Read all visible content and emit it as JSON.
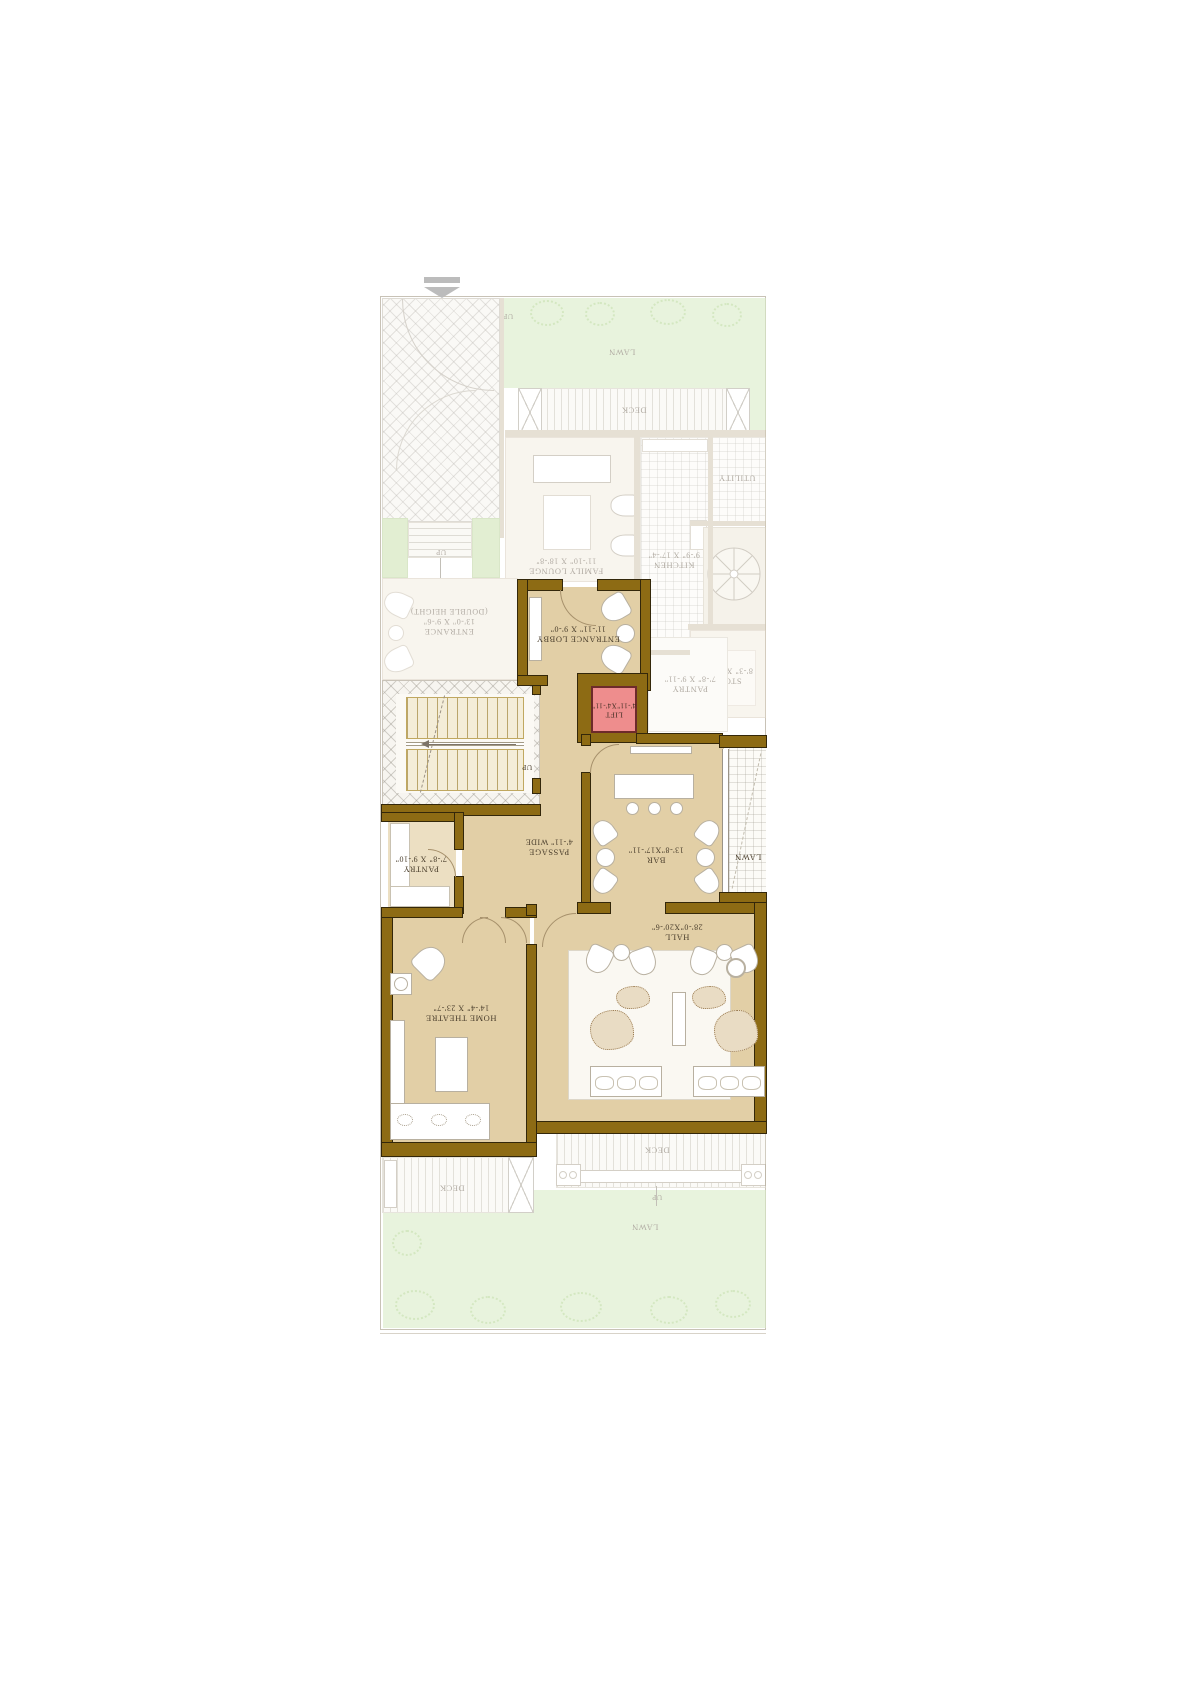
{
  "colors": {
    "wall": "#8d6b14",
    "active_floor": "#e2cfa6",
    "lift_fill": "#ee8d8d",
    "lawn_green": "#d9ecc7",
    "hatch_grey": "#c9c3b8",
    "label_text": "#4a3e2c"
  },
  "rooms": {
    "lawn_top": {
      "name": "LAWN"
    },
    "deck_top": {
      "name": "DECK"
    },
    "family_lounge": {
      "name": "FAMILY LOUNGE",
      "dims": "11'-10\" X 18'-8\""
    },
    "kitchen": {
      "name": "KITCHEN",
      "dims": "9'-9\" X 17'-4\""
    },
    "utility": {
      "name": "UTILITY"
    },
    "store": {
      "name": "STORE",
      "dims": "8'-3\" X 10'-7\""
    },
    "pantry_ground": {
      "name": "PANTRY",
      "dims": "7'-8\" X 9'-11\""
    },
    "entrance": {
      "name": "ENTRANCE",
      "dims": "13'-0\" X 9'-6\"",
      "note": "(DOUBLE HEIGHT)"
    },
    "entrance_lobby": {
      "name": "ENTRANCE LOBBY",
      "dims": "11'-11\" X 9'-0\""
    },
    "lift": {
      "name": "LIFT",
      "dims": "4'-11\"X4'-11\""
    },
    "passage": {
      "name": "PASSAGE",
      "dims": "4'-11\" WIDE"
    },
    "pantry": {
      "name": "PANTRY",
      "dims": "7'-8\" X 9'-10\""
    },
    "bar": {
      "name": "BAR",
      "dims": "13'-8\"X17'-11\""
    },
    "lawn_mid": {
      "name": "LAWN"
    },
    "hall": {
      "name": "HALL",
      "dims": "28'-0\"X20'-6\""
    },
    "home_theatre": {
      "name": "HOME THEATRE",
      "dims": "14'-4\" X 23'-7\""
    },
    "deck_bottom_left": {
      "name": "DECK"
    },
    "deck_bottom": {
      "name": "DECK"
    },
    "lawn_bottom": {
      "name": "LAWN"
    }
  },
  "annotations": {
    "up": "UP"
  }
}
